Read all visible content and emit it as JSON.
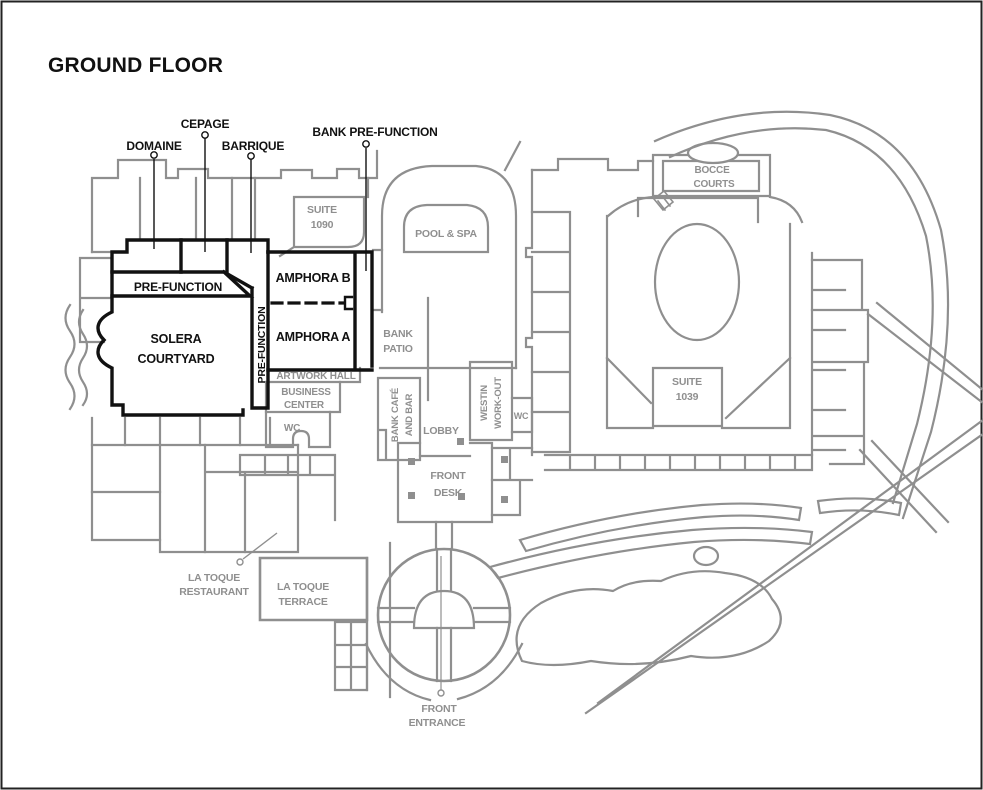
{
  "title": "GROUND FLOOR",
  "colors": {
    "wall_gray": "#8f8f8f",
    "wall_black": "#111111",
    "background": "#ffffff"
  },
  "callouts": {
    "domaine": "DOMAINE",
    "cepage": "CEPAGE",
    "barrique": "BARRIQUE",
    "bank_pre_function": "BANK PRE-FUNCTION"
  },
  "meeting": {
    "pre_function": "PRE-FUNCTION",
    "pre_function_corridor": "PRE-FUNCTION",
    "amphora_b": "AMPHORA B",
    "amphora_a": "AMPHORA A",
    "solera": [
      "SOLERA",
      "COURTYARD"
    ]
  },
  "areas": {
    "suite_1090": [
      "SUITE",
      "1090"
    ],
    "pool_spa": "POOL & SPA",
    "bocce_courts": [
      "BOCCE",
      "COURTS"
    ],
    "bank_patio": [
      "BANK",
      "PATIO"
    ],
    "artwork_hall": "ARTWORK HALL",
    "business_center": [
      "BUSINESS",
      "CENTER"
    ],
    "wc_business": "WC",
    "bank_cafe": [
      "BANK CAFÉ",
      "AND BAR"
    ],
    "lobby": "LOBBY",
    "westin_workout": [
      "WESTIN",
      "WORK-OUT"
    ],
    "wc_lobby": "WC",
    "suite_1039": [
      "SUITE",
      "1039"
    ],
    "front_desk": [
      "FRONT",
      "DESK"
    ],
    "la_toque_restaurant": [
      "LA TOQUE",
      "RESTAURANT"
    ],
    "la_toque_terrace": [
      "LA TOQUE",
      "TERRACE"
    ],
    "front_entrance": [
      "FRONT",
      "ENTRANCE"
    ]
  }
}
